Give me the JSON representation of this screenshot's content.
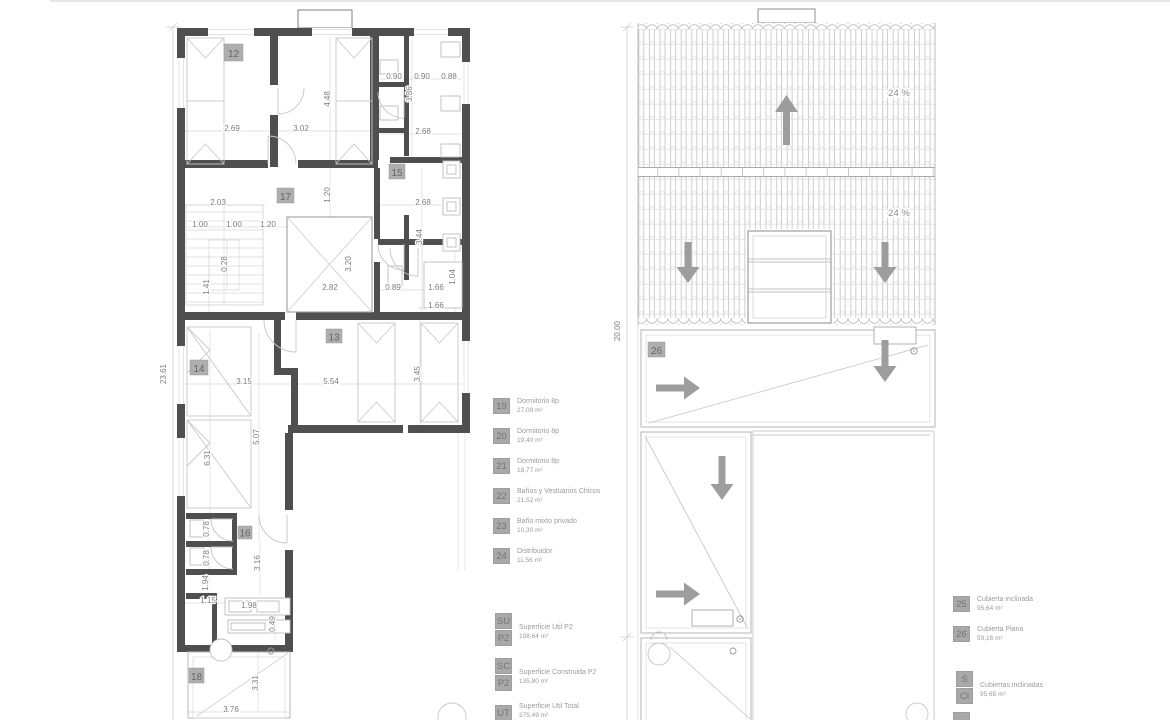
{
  "floor_plan": {
    "room_numbers": {
      "r12": "12",
      "r17": "17",
      "r15": "15",
      "r13": "13",
      "r14": "14",
      "r16": "16",
      "r18": "18"
    },
    "dims": [
      "2.69",
      "3.02",
      "4.48",
      "0.90",
      "0.90",
      "0.88",
      "3.86",
      "2.68",
      "2.03",
      "1.00",
      "1.00",
      "1.20",
      "1.20",
      "0.28",
      "1.41",
      "2.68",
      "3.44",
      "3.20",
      "2.82",
      "0.89",
      "1.66",
      "1.04",
      "1.66",
      "3.15",
      "5.54",
      "3.45",
      "5.07",
      "6.31",
      "0.78",
      "0.78",
      "1.94",
      "3.16",
      "1.15",
      "1.98",
      "0.49",
      "3.31",
      "3.76",
      "23.61"
    ]
  },
  "roof_plan": {
    "room_numbers": {
      "r26": "26"
    },
    "slope_labels": [
      "24 %",
      "24 %"
    ],
    "overall_dim": "20.00"
  },
  "legend_p2": {
    "items": [
      {
        "code": "19",
        "label": "Dormitorio  8p",
        "area": "27,09 m²"
      },
      {
        "code": "20",
        "label": "Dormitorio 8p",
        "area": "19,40 m²"
      },
      {
        "code": "21",
        "label": "Dormitorio 8p",
        "area": "18,77 m²"
      },
      {
        "code": "22",
        "label": "Baños y Vestuarios Chicos",
        "area": "21,52 m²"
      },
      {
        "code": "23",
        "label": "Baño mixto privado",
        "area": "10,30 m²"
      },
      {
        "code": "24",
        "label": "Distribuidor",
        "area": "11,56 m²"
      }
    ],
    "totals": [
      {
        "code_top": "SU",
        "code_bottom": "P2",
        "label": "Superficie Util P2",
        "area": "108,64 m²"
      },
      {
        "code_top": "SC",
        "code_bottom": "P2",
        "label": "Superficie Construida P2",
        "area": "135,80 m²"
      },
      {
        "code_top": "UT",
        "code_bottom": "",
        "label": "Superficie Util Total",
        "area": "375,49 m²"
      }
    ]
  },
  "legend_roof": {
    "items": [
      {
        "code": "25",
        "label": "Cubierta inclinada",
        "area": "95,64 m²"
      },
      {
        "code": "26",
        "label": "Cubierta Plana",
        "area": "59,16 m²"
      }
    ],
    "totals": [
      {
        "code_top": "S",
        "code_bottom": "Cl",
        "label": "Cubiertas inclinadas",
        "area": "95,65 m²"
      }
    ]
  },
  "colors": {
    "wall": "#4f4f4f",
    "light_line": "#c9c9c9",
    "arrow": "#9d9d9d",
    "label_box": "#aeaeae",
    "dim_text": "#7c7c7c",
    "legend_text": "#9b9b9b"
  }
}
